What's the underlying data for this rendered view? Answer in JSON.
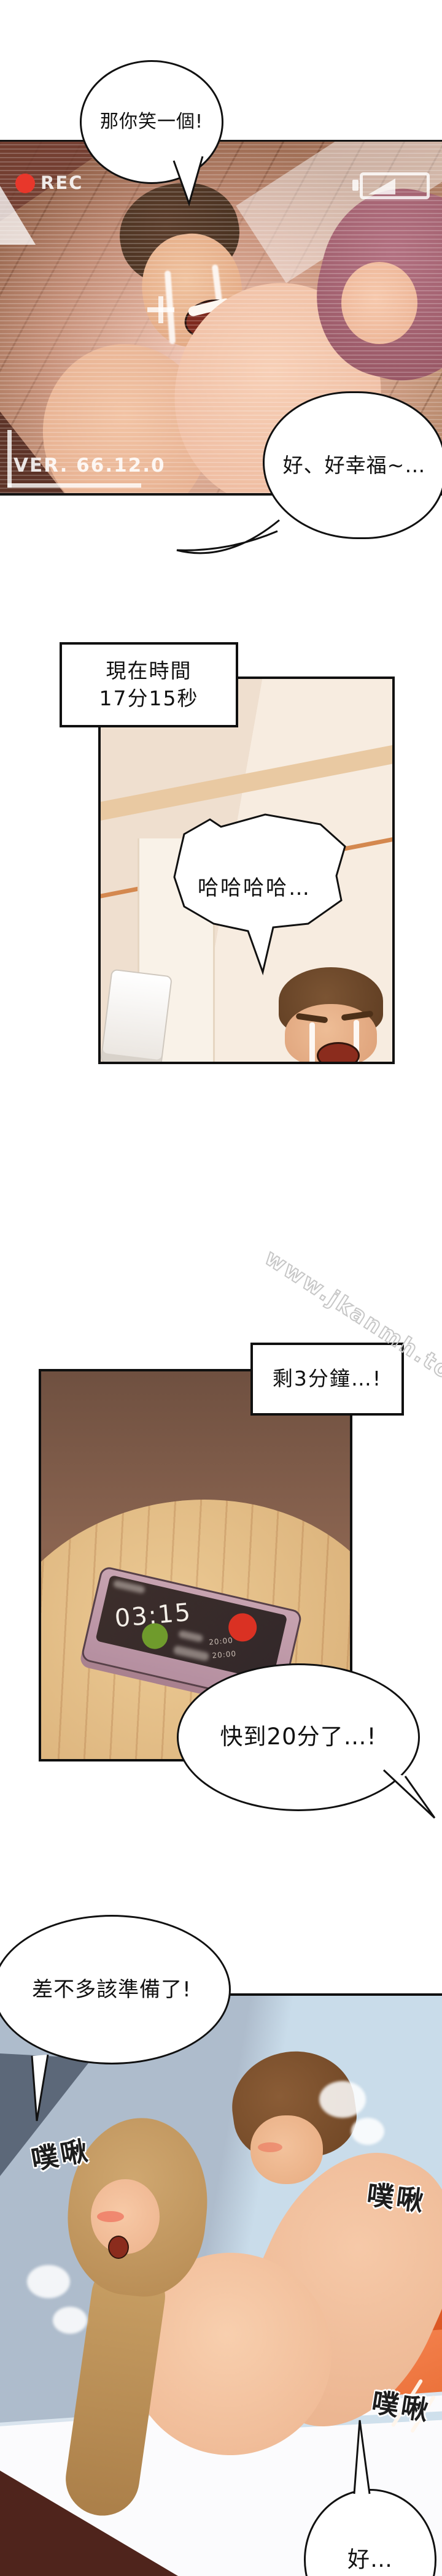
{
  "comic": {
    "watermark": "www.jkanmh.top",
    "panel1": {
      "bubble_smile": "那你笑一個!",
      "camera": {
        "rec_label": "REC",
        "version_label": "VER. 66.12.0"
      },
      "bubble_happy": "好、好幸福~…"
    },
    "panel2": {
      "narration_line1": "現在時間",
      "narration_line2": "17分15秒",
      "bubble_laugh": "哈哈哈哈…"
    },
    "panel3": {
      "narration": "剩3分鐘…!",
      "phone_time": "03:15",
      "phone_label1": "20:00",
      "phone_label2": "20:00",
      "bubble_twenty": "快到20分了…!"
    },
    "panel4": {
      "bubble_prepare": "差不多該準備了!",
      "sfx_left": "噗啾",
      "sfx_right": "噗啾",
      "sfx_lower": "噗啾",
      "bubble_ok": "好…"
    },
    "colors": {
      "rec_red": "#e8372b",
      "answer_green": "#6f9b2c",
      "decline_red": "#da3123",
      "couch_orange": "#e76a30",
      "table_tan": "#e0ba84",
      "wall_blue": "#c9dcea"
    }
  }
}
